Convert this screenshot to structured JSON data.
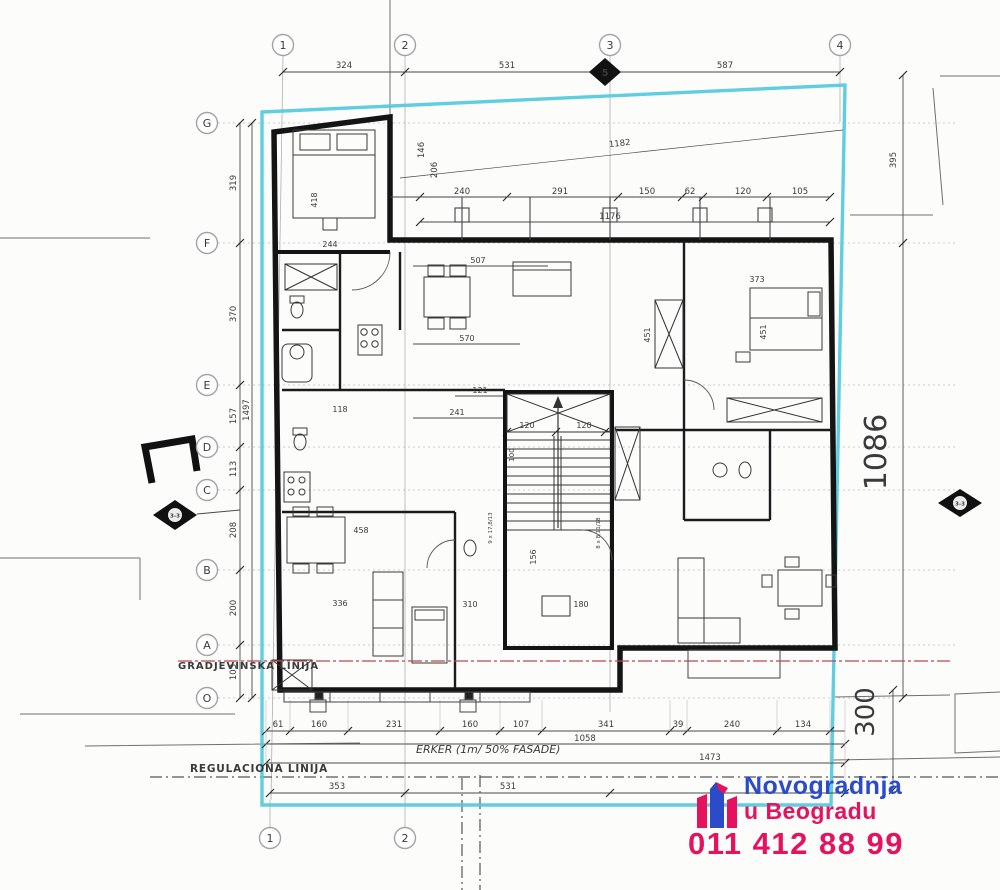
{
  "title": "apartment floor plan sheet",
  "grid": {
    "top": [
      "1",
      "2",
      "3",
      "4"
    ],
    "bottom": [
      "1",
      "2"
    ],
    "left": [
      "G",
      "F",
      "E",
      "D",
      "C",
      "B",
      "A",
      "O"
    ]
  },
  "sections": {
    "top": "5",
    "left": "3-3",
    "right": "3-3"
  },
  "dims": {
    "top": [
      "324",
      "531",
      "587"
    ],
    "row2": [
      "240",
      "291",
      "150",
      "62",
      "120",
      "105"
    ],
    "v1176": "1176",
    "v1182": "1182",
    "v146": "146",
    "v206": "206",
    "left": [
      "319",
      "370",
      "157",
      "113",
      "208",
      "200",
      "103"
    ],
    "left_total": "1497",
    "r395": "395",
    "r1086": "1086",
    "r300": "300",
    "b1": [
      "61",
      "160",
      "231",
      "160",
      "107",
      "341",
      "39",
      "240",
      "134"
    ],
    "b1058": "1058",
    "b1473": "1473",
    "b2": [
      "353",
      "531"
    ]
  },
  "interior": {
    "bed418": "418",
    "w244": "244",
    "liv507": "507",
    "liv570": "570",
    "c121": "121",
    "c241": "241",
    "wc118": "118",
    "br373": "373",
    "br451": "451",
    "sh451": "451",
    "din458": "458",
    "t336": "336",
    "bed310": "310",
    "lift180": "180",
    "v156": "156",
    "st120a": "120",
    "st120b": "120",
    "st100": "100",
    "note_l": "9 x 17,8/13",
    "note_r": "8 x 8,11/18"
  },
  "annotations": {
    "gradjevinska": "GRADJEVINSKA LINIJA",
    "regulaciona": "REGULACIONA LINIJA",
    "erker": "ERKER (1m/ 50% FASADE)"
  },
  "colors": {
    "parcel_cyan": "#4fc9dd",
    "building_line_red": "#b84a4a",
    "regulation_blue_text": "#4a5fc0",
    "logo_blue": "#2b4bc8",
    "logo_pink": "#e5135e"
  },
  "logo": {
    "brand_line1": "Novogradnja",
    "brand_line2": "u Beogradu",
    "phone": "011 412 88 99"
  }
}
